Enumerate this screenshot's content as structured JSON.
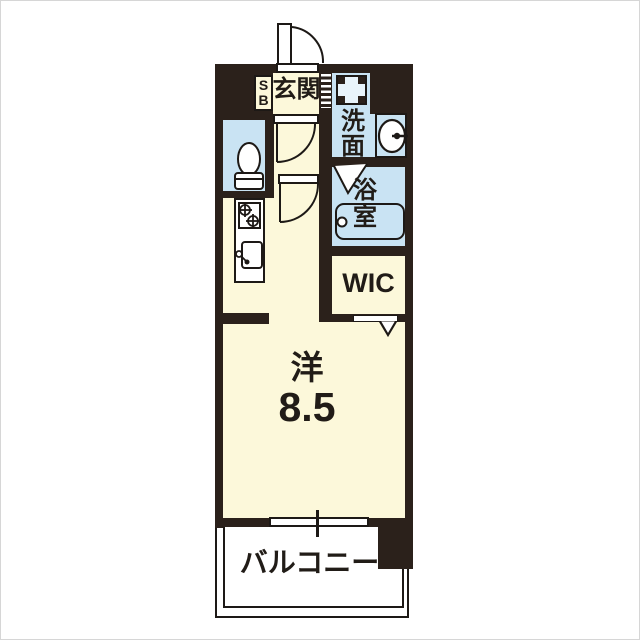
{
  "image_type": "apartment-floor-plan",
  "labels": {
    "shoe_box_line1": "S",
    "shoe_box_line2": "B",
    "genkan": "玄関",
    "washroom_char1": "洗",
    "washroom_char2": "面",
    "bathroom_char1": "浴",
    "bathroom_char2": "室",
    "wic": "WIC",
    "main_room_type": "洋",
    "main_room_size": "8.5",
    "balcony": "バルコニー"
  },
  "colors": {
    "wall": "#2b211b",
    "room_cream": "#fcf8da",
    "wet_area_blue": "#c9e3f3",
    "line": "#1d1916",
    "white": "#ffffff"
  },
  "icons": [
    "entrance-door-icon",
    "door-swing-icon",
    "shoe-cabinet-icon",
    "toilet-icon",
    "washing-machine-pan-icon",
    "vanity-sink-icon",
    "bathtub-icon",
    "folding-bath-door-icon",
    "gas-stove-icon",
    "kitchen-sink-icon",
    "sliding-closet-door-icon",
    "closet-open-arrow-icon",
    "window-icon",
    "balcony-railing-icon"
  ]
}
